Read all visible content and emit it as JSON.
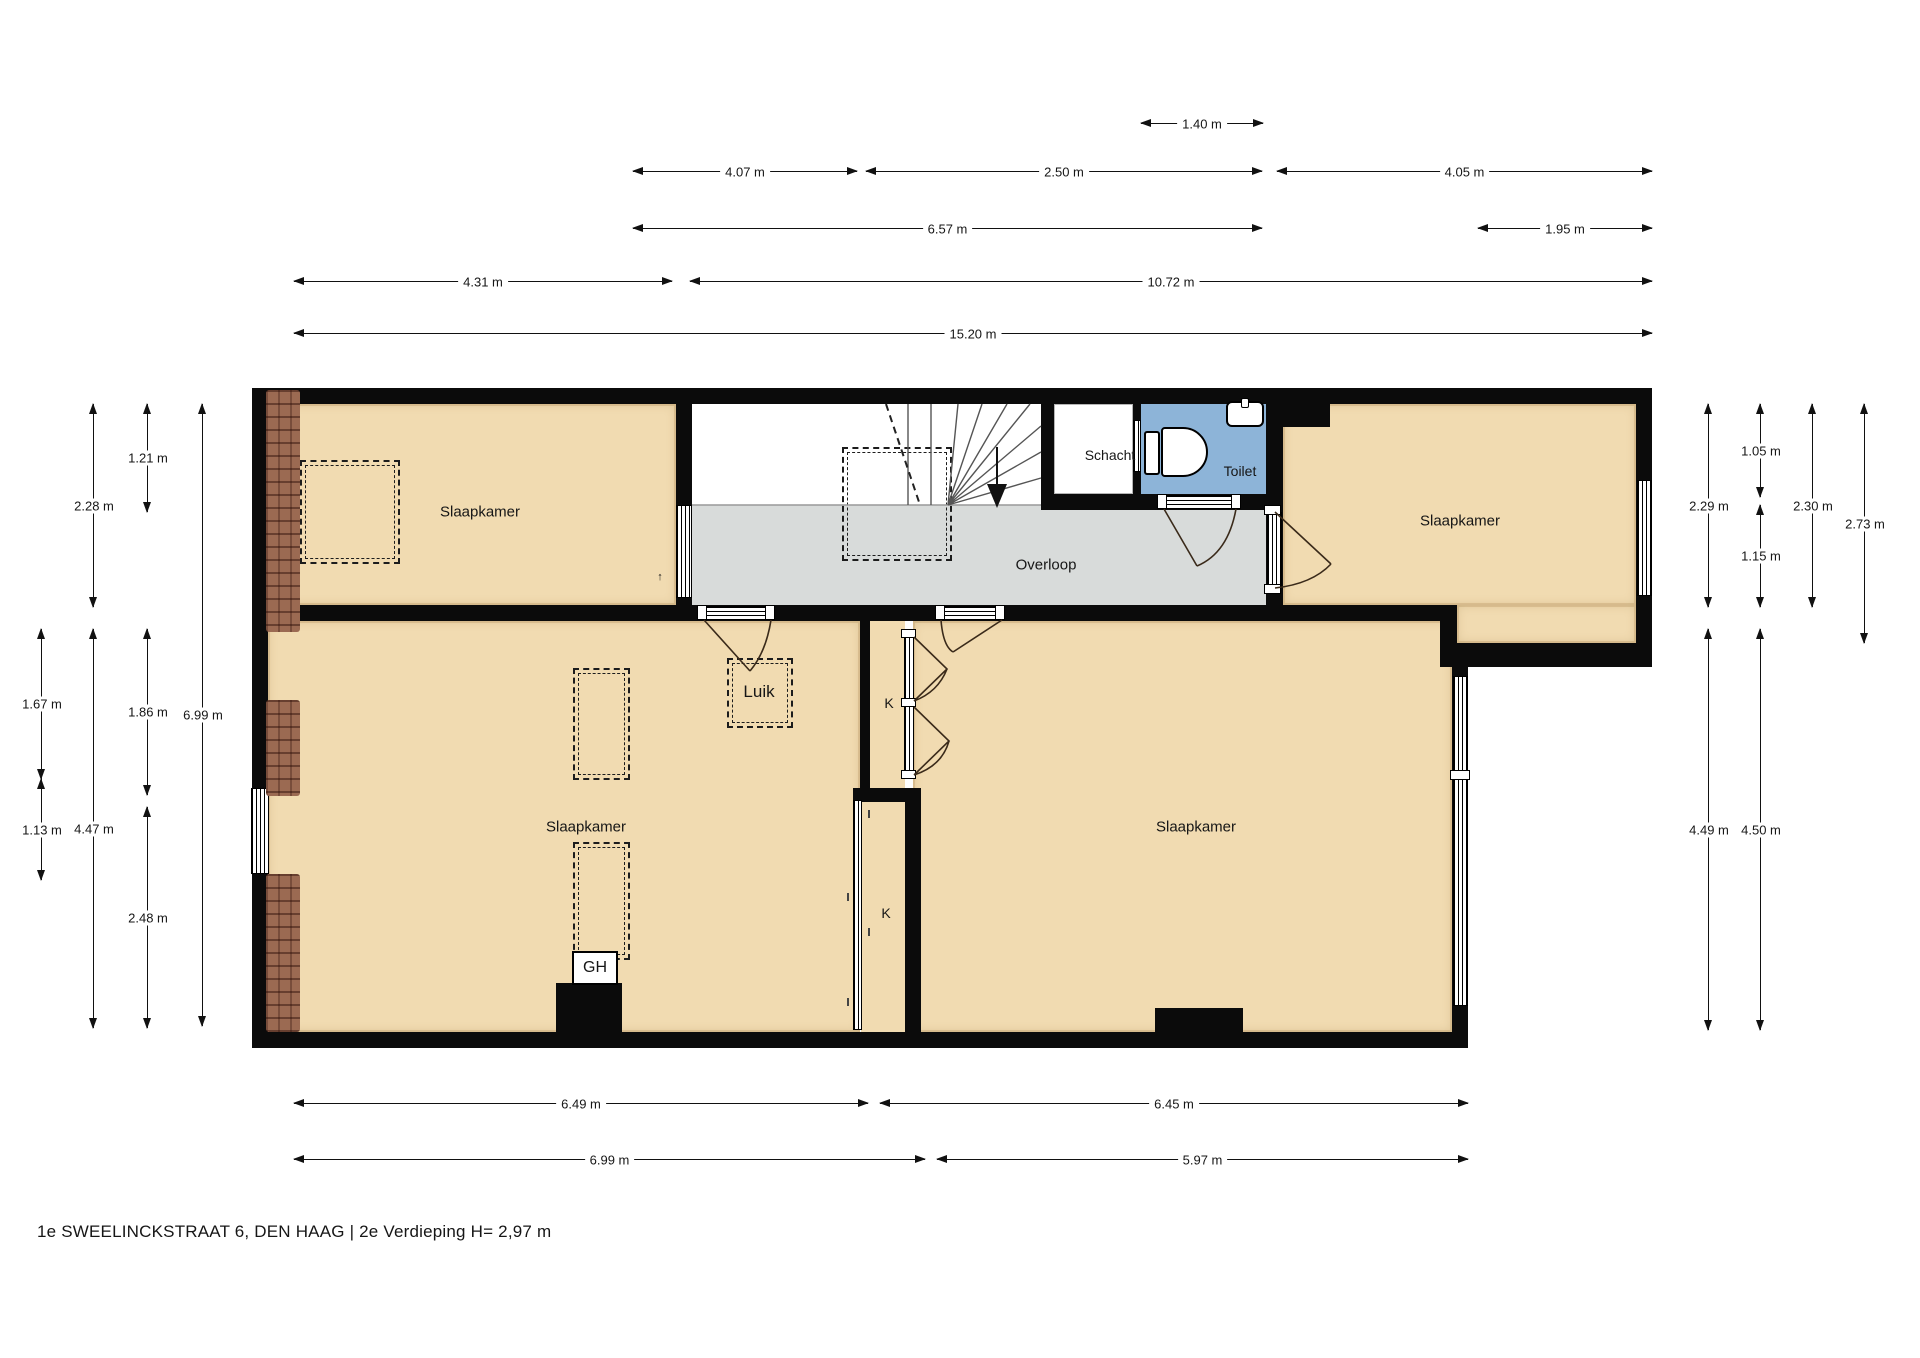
{
  "title": "1e SWEELINCKSTRAAT 6, DEN HAAG | 2e Verdieping H= 2,97 m",
  "rooms": {
    "slaapkamer_tl": "Slaapkamer",
    "slaapkamer_tr": "Slaapkamer",
    "slaapkamer_bl": "Slaapkamer",
    "slaapkamer_br": "Slaapkamer",
    "overloop": "Overloop",
    "schacht": "Schacht",
    "toilet": "Toilet",
    "luik": "Luik",
    "closet_upper": "K",
    "closet_lower": "K",
    "geiser": "GH",
    "arrow_mark": "↑"
  },
  "colors": {
    "wall": "#0b0b0b",
    "bedroom_floor": "#f1dbb1",
    "landing_floor": "#d8dbda",
    "toilet_floor": "#8db4d8",
    "brick": "#9b6a52"
  },
  "dimensions": [
    {
      "label": "1.40 m",
      "orient": "h",
      "x1": 1141,
      "x2": 1263,
      "y": 123
    },
    {
      "label": "4.07 m",
      "orient": "h",
      "x1": 633,
      "x2": 857,
      "y": 171
    },
    {
      "label": "2.50 m",
      "orient": "h",
      "x1": 866,
      "x2": 1262,
      "y": 171
    },
    {
      "label": "4.05 m",
      "orient": "h",
      "x1": 1277,
      "x2": 1652,
      "y": 171
    },
    {
      "label": "6.57 m",
      "orient": "h",
      "x1": 633,
      "x2": 1262,
      "y": 228
    },
    {
      "label": "1.95 m",
      "orient": "h",
      "x1": 1478,
      "x2": 1652,
      "y": 228
    },
    {
      "label": "4.31 m",
      "orient": "h",
      "x1": 294,
      "x2": 672,
      "y": 281
    },
    {
      "label": "10.72 m",
      "orient": "h",
      "x1": 690,
      "x2": 1652,
      "y": 281
    },
    {
      "label": "15.20 m",
      "orient": "h",
      "x1": 294,
      "x2": 1652,
      "y": 333
    },
    {
      "label": "6.49 m",
      "orient": "h",
      "x1": 294,
      "x2": 868,
      "y": 1103
    },
    {
      "label": "6.45 m",
      "orient": "h",
      "x1": 880,
      "x2": 1468,
      "y": 1103
    },
    {
      "label": "6.99 m",
      "orient": "h",
      "x1": 294,
      "x2": 925,
      "y": 1159
    },
    {
      "label": "5.97 m",
      "orient": "h",
      "x1": 937,
      "x2": 1468,
      "y": 1159
    },
    {
      "label": "2.28 m",
      "orient": "v",
      "y1": 404,
      "y2": 607,
      "x": 93
    },
    {
      "label": "1.21 m",
      "orient": "v",
      "y1": 404,
      "y2": 512,
      "x": 147
    },
    {
      "label": "6.99 m",
      "orient": "v",
      "y1": 404,
      "y2": 1026,
      "x": 202
    },
    {
      "label": "1.67 m",
      "orient": "v",
      "y1": 629,
      "y2": 779,
      "x": 41
    },
    {
      "label": "1.13 m",
      "orient": "v",
      "y1": 779,
      "y2": 880,
      "x": 41
    },
    {
      "label": "4.47 m",
      "orient": "v",
      "y1": 629,
      "y2": 1028,
      "x": 93
    },
    {
      "label": "1.86 m",
      "orient": "v",
      "y1": 629,
      "y2": 795,
      "x": 147
    },
    {
      "label": "2.48 m",
      "orient": "v",
      "y1": 807,
      "y2": 1028,
      "x": 147
    },
    {
      "label": "2.29 m",
      "orient": "v",
      "y1": 404,
      "y2": 607,
      "x": 1708
    },
    {
      "label": "4.49 m",
      "orient": "v",
      "y1": 629,
      "y2": 1030,
      "x": 1708
    },
    {
      "label": "1.05 m",
      "orient": "v",
      "y1": 404,
      "y2": 497,
      "x": 1760
    },
    {
      "label": "1.15 m",
      "orient": "v",
      "y1": 505,
      "y2": 607,
      "x": 1760
    },
    {
      "label": "4.50 m",
      "orient": "v",
      "y1": 629,
      "y2": 1030,
      "x": 1760
    },
    {
      "label": "2.30 m",
      "orient": "v",
      "y1": 404,
      "y2": 607,
      "x": 1812
    },
    {
      "label": "2.73 m",
      "orient": "v",
      "y1": 404,
      "y2": 643,
      "x": 1864
    }
  ]
}
